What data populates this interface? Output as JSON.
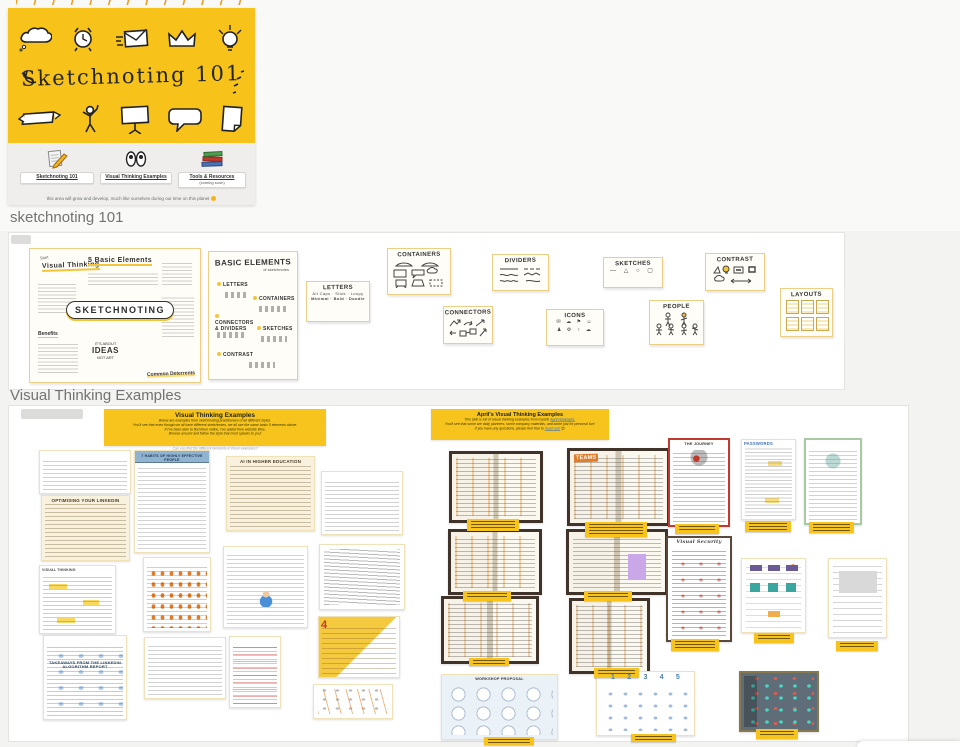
{
  "hero": {
    "title": "Sketchnoting 101",
    "banner_color": "#f7c31b",
    "doodles_top": [
      "thought-cloud-icon",
      "alarm-clock-icon",
      "envelope-icon",
      "crown-icon",
      "lightbulb-icon"
    ],
    "doodles_bottom": [
      "ribbon-banner-icon",
      "stick-figure-icon",
      "sign-placard-icon",
      "speech-bubble-icon",
      "paper-sheet-icon"
    ],
    "nav": [
      {
        "label": "Sketchnoting 101",
        "icon": "pencil-paper-icon"
      },
      {
        "label": "Visual Thinking Examples",
        "icon": "eyes-icon"
      },
      {
        "label": "Tools & Resources",
        "sublabel": "(coming soon)",
        "icon": "book-stack-icon"
      }
    ],
    "footnote": "this area will grow and develop, much like ourselves during our time on this planet",
    "footnote_icon": "sun-emoji"
  },
  "section_titles": {
    "first": "sketchnoting 101",
    "second": "Visual Thinking Examples"
  },
  "strip_cards": {
    "overview": {
      "start": "Start",
      "title": "Visual Thinking",
      "heading": "5 Basic Elements",
      "center": "SKETCHNOTING",
      "benefits": "Benefits",
      "about1": "IT'S ABOUT",
      "about2": "IDEAS",
      "about3": "NOT ART",
      "deterrents": "Common Deterrents"
    },
    "basic_elements": {
      "title": "Basic Elements",
      "subtitle": "of sketchnotes",
      "items": [
        "Letters",
        "Containers",
        "Connectors & Dividers",
        "Sketches",
        "Contrast"
      ]
    },
    "letters": {
      "title": "Letters",
      "row1": "All Caps · Stick · Loopy",
      "row2": "Minimal · Bold · Doodle"
    },
    "containers": {
      "title": "Containers"
    },
    "dividers": {
      "title": "Dividers"
    },
    "connectors": {
      "title": "Connectors"
    },
    "icons_card": {
      "title": "Icons",
      "row1": "✉ ☁ ⚑ ☺",
      "row2": "♟ ⚙ ♀ ☁"
    },
    "sketches": {
      "title": "Sketches",
      "glyphs": "—  △  ○  ▢"
    },
    "contrast": {
      "title": "Contrast"
    },
    "people": {
      "title": "People"
    },
    "layouts": {
      "title": "Layouts"
    }
  },
  "examples": {
    "left_header": {
      "title": "Visual Thinking Examples",
      "lines": [
        "Below are examples from sketchnoting practitioners of all different styles.",
        "You'll see that even though we all have different sketchnotes, we all use the same basic 5 elements above.",
        "If I've been able to find them online, I've added their website links.",
        "Browse around and follow the style that most speaks to you!"
      ]
    },
    "left_caption": "Can you find the different elements in these examples?",
    "right_header": {
      "title": "April's Visual Thinking Examples",
      "line1_prefix": "This side is full of visual thinking examples from myself,",
      "line1_link": "April Heinmann.",
      "line2": "You'll see that some are daily planners, some company materials, and some just for personal fun!",
      "line3_prefix": "If you have any questions, please feel free to",
      "line3_link": "reach out!",
      "line3_emoji": "😊"
    },
    "accent_yellow": "#f6c41c",
    "items": [
      {
        "name": "thumb-busy-color",
        "kind": "busy",
        "x": 30,
        "y": 44,
        "w": 90,
        "h": 42
      },
      {
        "name": "thumb-7-habits",
        "kind": "banner-portrait",
        "x": 125,
        "y": 44,
        "w": 74,
        "h": 101,
        "title": "7 HABITS OF HIGHLY EFFECTIVE PEOPLE"
      },
      {
        "name": "thumb-ai-higher-ed",
        "kind": "cream",
        "x": 217,
        "y": 50,
        "w": 87,
        "h": 73,
        "title": "AI IN HIGHER EDUCATION"
      },
      {
        "name": "thumb-color-grid",
        "kind": "colorgrid",
        "x": 312,
        "y": 65,
        "w": 80,
        "h": 62
      },
      {
        "name": "thumb-linkedin-optimising",
        "kind": "cream",
        "x": 32,
        "y": 89,
        "w": 87,
        "h": 64,
        "title": "OPTIMISING YOUR LINKEDIN"
      },
      {
        "name": "thumb-visual-thinking",
        "kind": "yellowhl",
        "x": 30,
        "y": 159,
        "w": 75,
        "h": 67,
        "title": "VISUAL THINKING"
      },
      {
        "name": "thumb-orange-list",
        "kind": "orangelist",
        "x": 134,
        "y": 151,
        "w": 66,
        "h": 73
      },
      {
        "name": "thumb-boy-notes",
        "kind": "boy",
        "x": 214,
        "y": 140,
        "w": 83,
        "h": 80
      },
      {
        "name": "thumb-gray-scribble",
        "kind": "grayscribble",
        "x": 310,
        "y": 138,
        "w": 84,
        "h": 64
      },
      {
        "name": "thumb-linkedin-takeaways",
        "kind": "bluescribble",
        "x": 34,
        "y": 229,
        "w": 82,
        "h": 83,
        "title": "TAKEAWAYS FROM THE LINKEDIN ALGORITHM REPORT"
      },
      {
        "name": "thumb-orange-grid",
        "kind": "colorgrid",
        "x": 135,
        "y": 231,
        "w": 80,
        "h": 60
      },
      {
        "name": "thumb-red-portrait",
        "kind": "redlist",
        "x": 220,
        "y": 230,
        "w": 50,
        "h": 70
      },
      {
        "name": "thumb-diagonal-4",
        "kind": "diag4",
        "x": 309,
        "y": 210,
        "w": 80,
        "h": 60,
        "title": "4"
      },
      {
        "name": "thumb-flow-arrows",
        "kind": "flow",
        "x": 304,
        "y": 278,
        "w": 78,
        "h": 33
      },
      {
        "name": "thumb-notebook-1",
        "kind": "notebook",
        "x": 440,
        "y": 45,
        "w": 88,
        "h": 66
      },
      {
        "name": "thumb-notebook-teams",
        "kind": "notebook",
        "x": 558,
        "y": 42,
        "w": 97,
        "h": 72,
        "title": "TEAMS"
      },
      {
        "name": "thumb-the-journey",
        "kind": "redjourney",
        "x": 659,
        "y": 32,
        "w": 58,
        "h": 85,
        "title": "THE JOURNEY"
      },
      {
        "name": "thumb-passwords",
        "kind": "passwords",
        "x": 732,
        "y": 33,
        "w": 53,
        "h": 79,
        "title": "PASSWORDS"
      },
      {
        "name": "thumb-green-card",
        "kind": "greencard",
        "x": 795,
        "y": 32,
        "w": 54,
        "h": 83
      },
      {
        "name": "thumb-notebook-2",
        "kind": "notebook",
        "x": 439,
        "y": 123,
        "w": 88,
        "h": 60
      },
      {
        "name": "thumb-notebook-purple",
        "kind": "notebook-purple",
        "x": 557,
        "y": 123,
        "w": 96,
        "h": 60
      },
      {
        "name": "thumb-visual-security",
        "kind": "security",
        "x": 657,
        "y": 130,
        "w": 62,
        "h": 102,
        "title": "Visual Security"
      },
      {
        "name": "thumb-kanban-board",
        "kind": "kanban",
        "x": 732,
        "y": 152,
        "w": 63,
        "h": 73
      },
      {
        "name": "thumb-gantt-chart",
        "kind": "gantt",
        "x": 819,
        "y": 152,
        "w": 57,
        "h": 78
      },
      {
        "name": "thumb-notebook-3",
        "kind": "notebook",
        "x": 432,
        "y": 190,
        "w": 92,
        "h": 62
      },
      {
        "name": "thumb-notebook-4",
        "kind": "notebook",
        "x": 560,
        "y": 192,
        "w": 75,
        "h": 70
      },
      {
        "name": "thumb-workshop-proposal",
        "kind": "workshop",
        "x": 432,
        "y": 268,
        "w": 115,
        "h": 64,
        "title": "WORKSHOP PROPOSAL"
      },
      {
        "name": "thumb-five-steps",
        "kind": "steps",
        "x": 587,
        "y": 265,
        "w": 97,
        "h": 63,
        "title": "1 2 3 4 5"
      },
      {
        "name": "thumb-slate-board",
        "kind": "slate",
        "x": 730,
        "y": 265,
        "w": 76,
        "h": 57
      },
      {
        "name": "caption-label",
        "kind": "caption",
        "x": 458,
        "y": 113,
        "w": 52,
        "h": 12
      },
      {
        "name": "caption-label",
        "kind": "caption",
        "x": 576,
        "y": 116,
        "w": 62,
        "h": 15
      },
      {
        "name": "caption-label",
        "kind": "caption",
        "x": 666,
        "y": 118,
        "w": 44,
        "h": 10
      },
      {
        "name": "caption-label",
        "kind": "caption",
        "x": 736,
        "y": 115,
        "w": 46,
        "h": 11
      },
      {
        "name": "caption-label",
        "kind": "caption",
        "x": 800,
        "y": 116,
        "w": 45,
        "h": 11
      },
      {
        "name": "caption-label",
        "kind": "caption",
        "x": 454,
        "y": 185,
        "w": 48,
        "h": 10
      },
      {
        "name": "caption-label",
        "kind": "caption",
        "x": 575,
        "y": 185,
        "w": 48,
        "h": 10
      },
      {
        "name": "caption-label",
        "kind": "caption",
        "x": 662,
        "y": 233,
        "w": 48,
        "h": 12
      },
      {
        "name": "caption-label",
        "kind": "caption",
        "x": 745,
        "y": 227,
        "w": 40,
        "h": 10
      },
      {
        "name": "caption-label",
        "kind": "caption",
        "x": 827,
        "y": 235,
        "w": 42,
        "h": 10
      },
      {
        "name": "caption-label",
        "kind": "caption",
        "x": 460,
        "y": 252,
        "w": 40,
        "h": 8
      },
      {
        "name": "caption-label",
        "kind": "caption",
        "x": 585,
        "y": 262,
        "w": 45,
        "h": 10
      },
      {
        "name": "caption-label",
        "kind": "caption",
        "x": 475,
        "y": 331,
        "w": 50,
        "h": 8
      },
      {
        "name": "caption-label",
        "kind": "caption",
        "x": 622,
        "y": 328,
        "w": 45,
        "h": 8
      },
      {
        "name": "caption-label",
        "kind": "caption",
        "x": 747,
        "y": 323,
        "w": 42,
        "h": 10
      }
    ]
  }
}
